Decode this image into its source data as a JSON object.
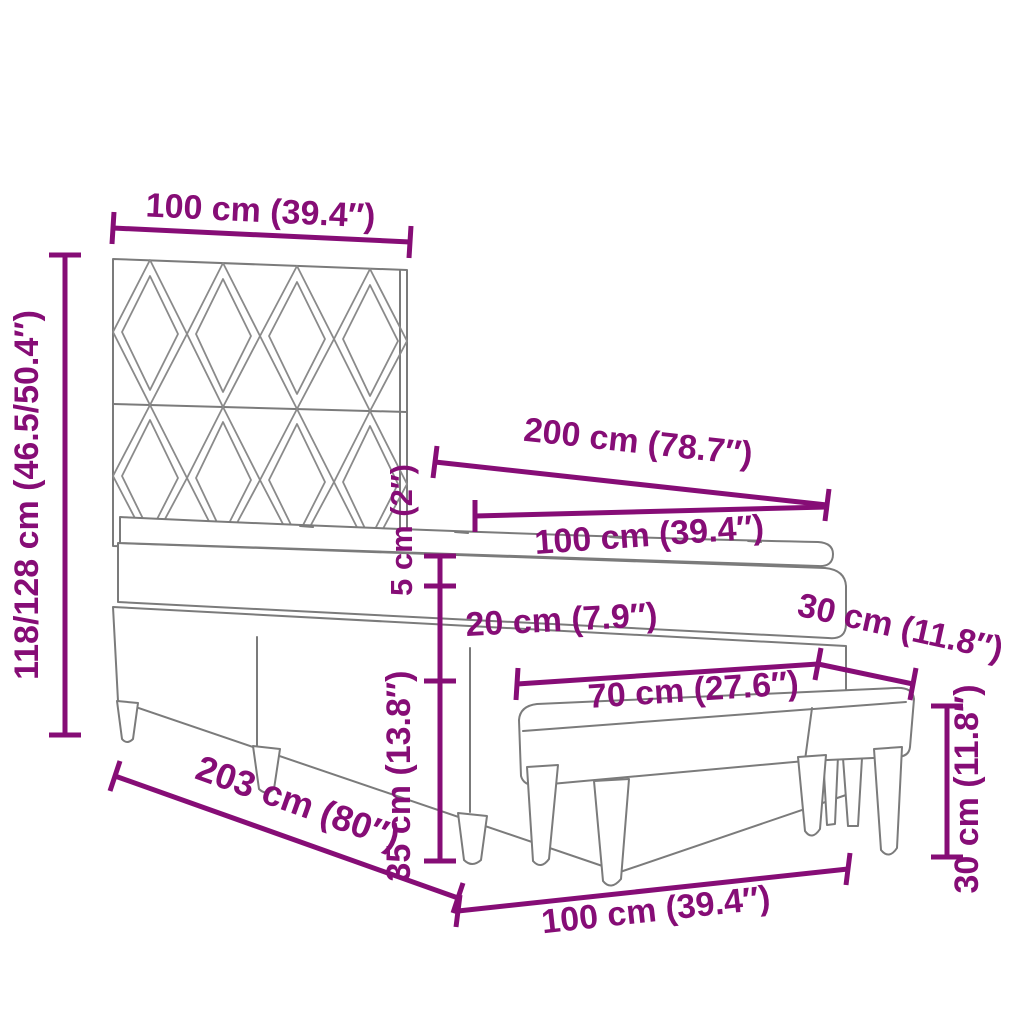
{
  "colors": {
    "dimension_accent": "#860d76",
    "line_art": "#7b7b7b",
    "background": "#ffffff"
  },
  "dimensions": {
    "headboard_width": "100 cm (39.4″)",
    "headboard_height": "118/128 cm (46.5/50.4″)",
    "bed_length_top": "200 cm (78.7″)",
    "mattress_width": "100 cm (39.4″)",
    "topper_height": "5 cm (2″)",
    "mattress_height": "20 cm (7.9″)",
    "base_height": "35 cm (13.8″)",
    "bench_depth": "30 cm (11.8″)",
    "bench_width": "70 cm (27.6″)",
    "bench_height": "30 cm (11.8″)",
    "bed_length_bottom": "203 cm (80″)",
    "bed_width_bottom": "100 cm (39.4″)"
  }
}
